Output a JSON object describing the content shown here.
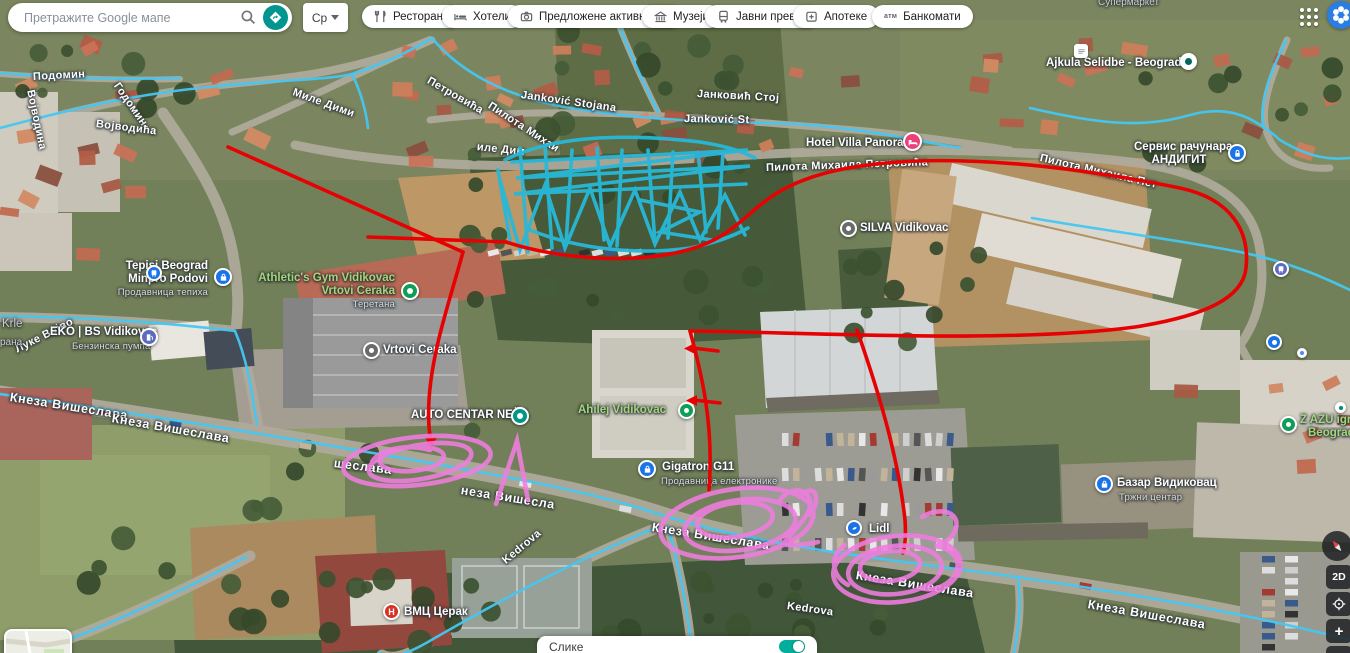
{
  "topbar": {
    "search_placeholder": "Претражите Google мапе",
    "lang_button": "Ср",
    "chips": [
      "Ресторани",
      "Хотели",
      "Предложене активности",
      "Музеји",
      "Јавни превоз",
      "Апотеке",
      "Банкомати"
    ],
    "atm_icon_text": "атм"
  },
  "streets": {
    "podomin": "Подомин",
    "vojvodina": "Војводина",
    "godomin": "Годомин",
    "mile_dimic": "Миле Дими",
    "petrovica": "Петровића",
    "pilota_mihai": "Пилота Михаи",
    "jankovic_stojana": "Janković Stojana",
    "jankovic_stoj": "Јанковић Стој",
    "jankovic_st": "Janković St",
    "ile_dim": "иле Дим",
    "pilota_full": "Пилота Михаила Петровића",
    "pilota_right": "Пилота Михаила Пет",
    "vojvodica": "Војводића",
    "luke_vojvo": "Луке Војво",
    "kneza_1": "Кнеза Вишеслава",
    "kneza_2": "Кнеза Вишеслава",
    "kneza_3": "шеслава",
    "kneza_4": "неза Вишесла",
    "kneza_5": "Кнеза Вишеслава",
    "kneza_6": "Кнеза Вишеслава",
    "kneza_7": "Кнеза Вишеслава",
    "kedrova_1": "Kedrova",
    "kedrova_2": "Kedrova"
  },
  "pois": {
    "supermarket": "Супермаркет",
    "krle": "Krle",
    "rana": "рана",
    "ajkula": "Ajkula Selidbe - Beograd",
    "hotel_villa": "Hotel Villa Panorama",
    "servis_1": "Сервис рачунара",
    "servis_2": "АНДИГИТ",
    "silva": "SILVA Vidikovac",
    "tepisi_1": "Tepisi Beograd",
    "tepisi_2": "Minpro Podovi",
    "tepisi_sub": "Продавница тепиха",
    "athletic_1": "Athletic's Gym Vidikovac",
    "athletic_2": "Vrtovi Ceraka",
    "athletic_sub": "Теретана",
    "eko": "EKO | BS Vidikovac",
    "eko_sub": "Бензинска пумпа",
    "vrtovi": "Vrtovi Ceraka",
    "auto_centar": "AUTO CENTAR NEŠA",
    "ahilej": "Ahilej Vidikovac",
    "gigatron": "Gigatron G11",
    "gigatron_sub": "Продавница електронике",
    "lidl": "Lidl",
    "bazar": "Базар Видиковац",
    "bazar_sub": "Тржни центар",
    "zazu_1": "Z AZU igrao",
    "zazu_2": "Beograd",
    "vmc": "ВМЦ Церак",
    "vmc_icon_letter": "Н"
  },
  "controls": {
    "mode_2d": "2D",
    "zoom_in": "+",
    "zoom_out": "–",
    "images_panel": "Слике"
  },
  "annotations": {
    "colors": {
      "red": "#e60202",
      "cyan": "#27b8d9",
      "pink": "#f07de0",
      "transit_blue": "#45c7f2"
    },
    "numbers": [
      "1",
      "2",
      "3"
    ]
  }
}
